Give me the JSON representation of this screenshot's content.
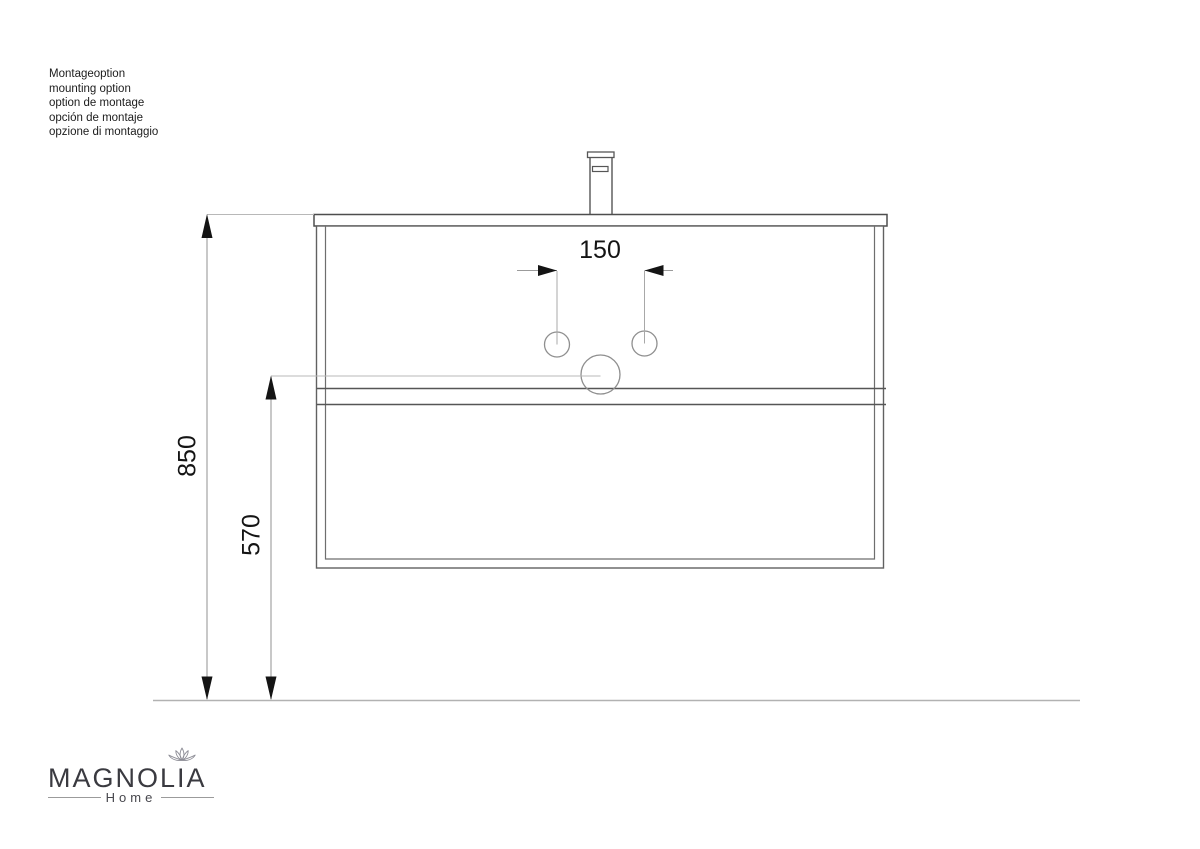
{
  "notes": {
    "lines": [
      "Montageoption",
      "mounting option",
      "option de montage",
      "opción de montaje",
      "opzione di montaggio"
    ]
  },
  "drawing": {
    "dimensions": {
      "hole_spacing_mm": "150",
      "total_height_mm": "850",
      "drain_height_mm": "570"
    }
  },
  "logo": {
    "brand": "MAGNOLIA",
    "sub_label": "Home"
  },
  "colors": {
    "drawing_line": "#5c5c5c",
    "dimension_line": "#9b9b9b",
    "leader_line": "#b8b8b8",
    "floor_line": "#b2b2b2",
    "text": "#141414",
    "logo_text": "#3a3a40"
  }
}
